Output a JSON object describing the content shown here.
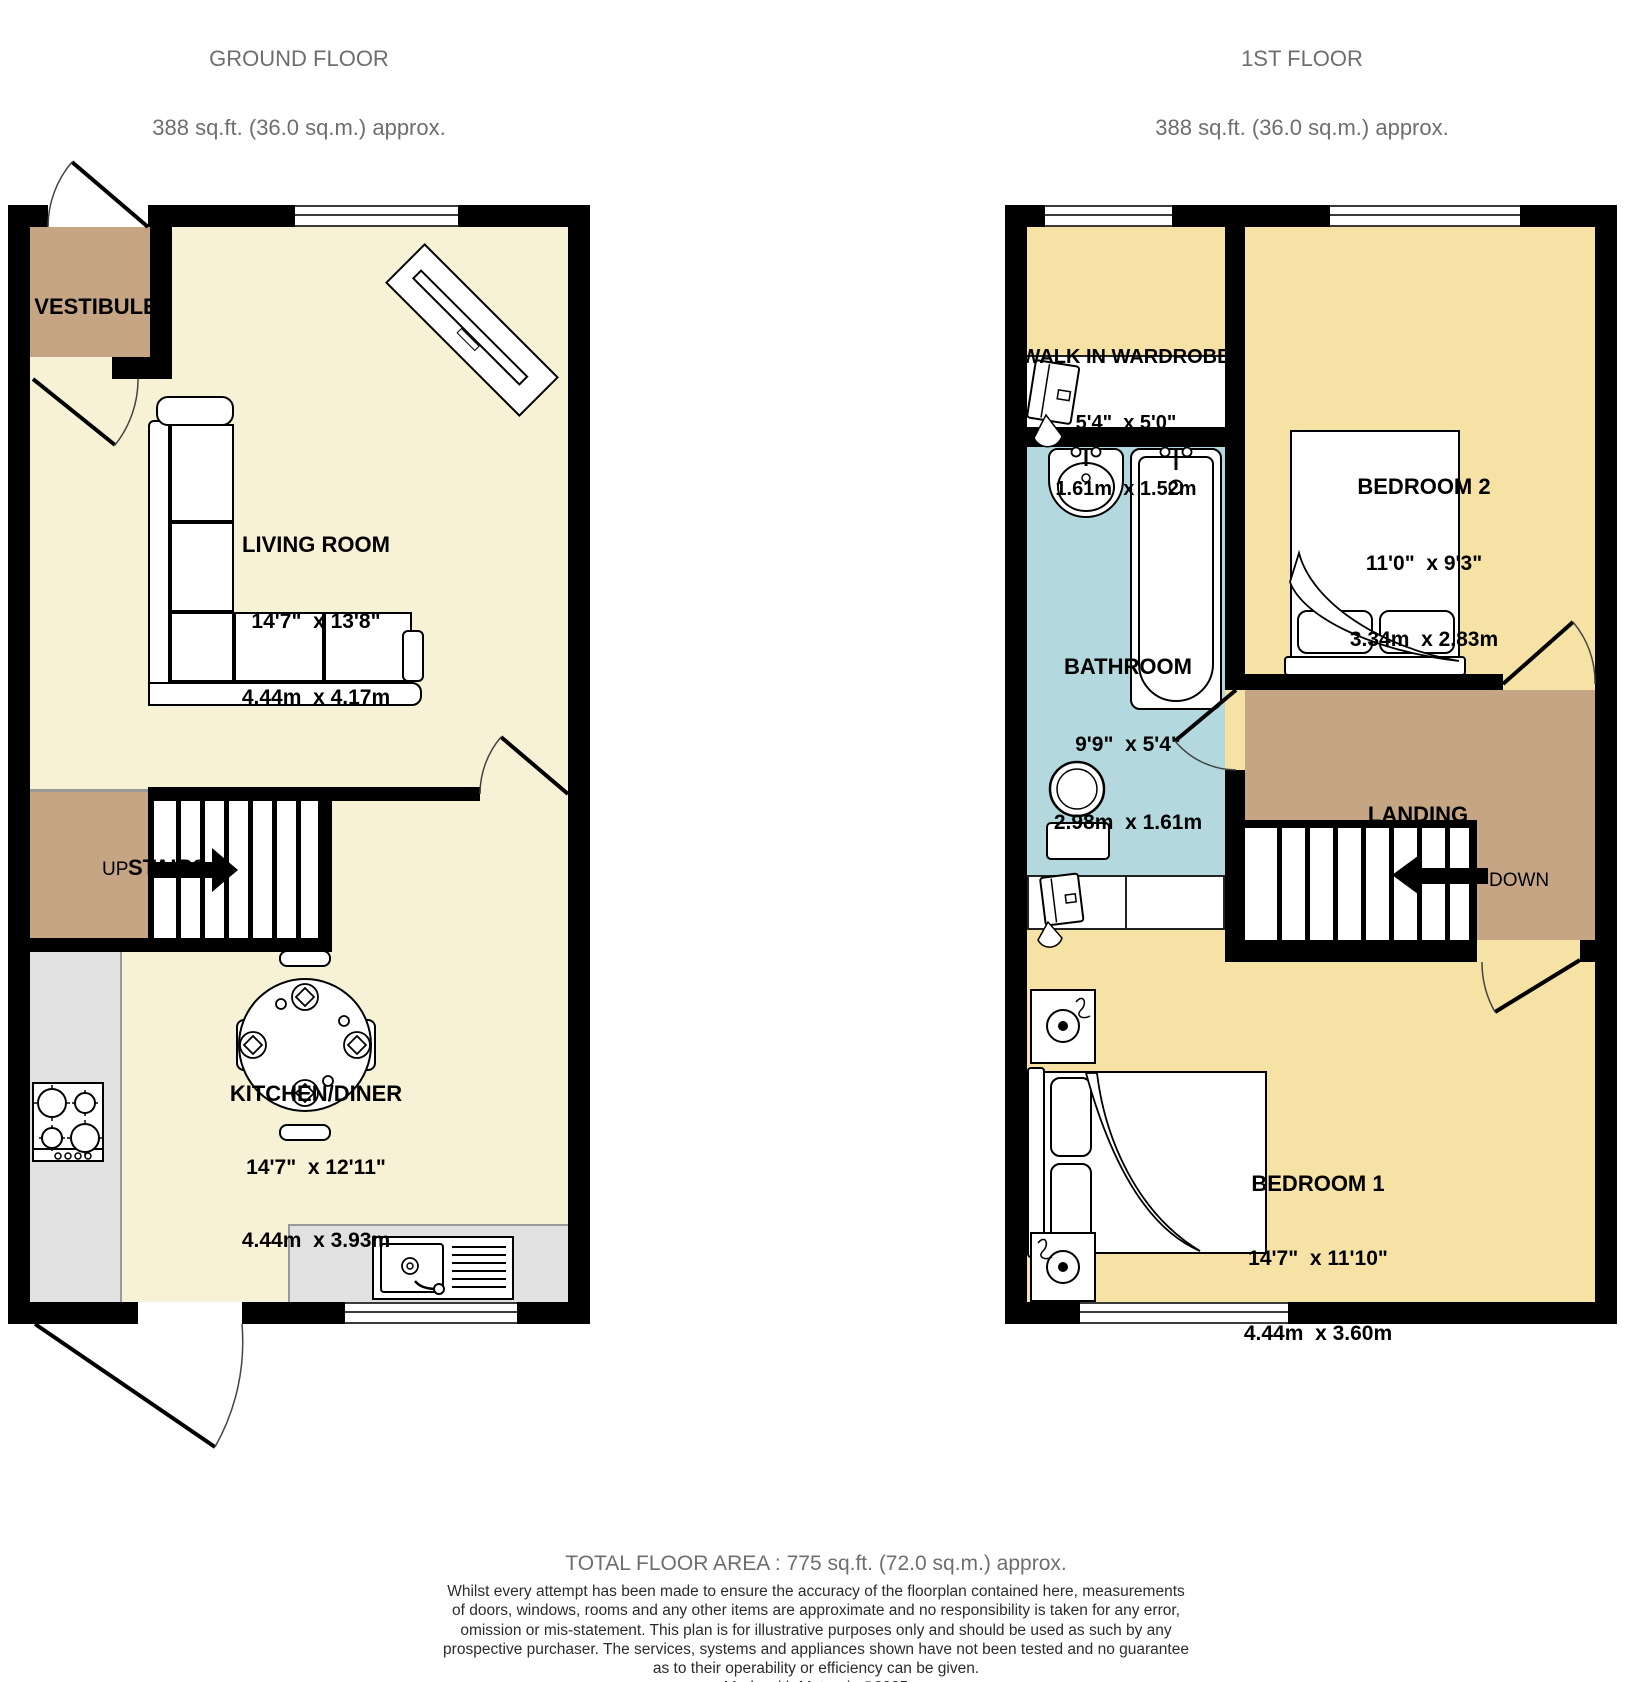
{
  "ground_floor": {
    "title": "GROUND FLOOR",
    "area": "388 sq.ft. (36.0 sq.m.) approx.",
    "rooms": {
      "vestibule": {
        "name": "VESTIBULE"
      },
      "living_room": {
        "name": "LIVING ROOM",
        "imperial": "14'7\"  x 13'8\"",
        "metric": "4.44m  x 4.17m"
      },
      "kitchen_diner": {
        "name": "KITCHEN/DINER",
        "imperial": "14'7\"  x 12'11\"",
        "metric": "4.44m  x 3.93m"
      },
      "stairs": {
        "name": "STAIRS",
        "direction": "UP"
      }
    }
  },
  "first_floor": {
    "title": "1ST FLOOR",
    "area": "388 sq.ft. (36.0 sq.m.) approx.",
    "rooms": {
      "walk_in_wardrobe": {
        "name": "WALK IN WARDROBE",
        "imperial": "5'4\"  x 5'0\"",
        "metric": "1.61m  x 1.52m"
      },
      "bedroom2": {
        "name": "BEDROOM 2",
        "imperial": "11'0\"  x 9'3\"",
        "metric": "3.34m  x 2.83m"
      },
      "bathroom": {
        "name": "BATHROOM",
        "imperial": "9'9\"  x 5'4\"",
        "metric": "2.98m  x 1.61m"
      },
      "landing": {
        "name": "LANDING",
        "direction": "DOWN"
      },
      "bedroom1": {
        "name": "BEDROOM 1",
        "imperial": "14'7\"  x 11'10\"",
        "metric": "4.44m  x 3.60m"
      }
    }
  },
  "footer": {
    "total_area": "TOTAL FLOOR AREA : 775 sq.ft. (72.0 sq.m.) approx.",
    "disclaimer_lines": [
      "Whilst every attempt has been made to ensure the accuracy of the floorplan contained here, measurements",
      "of doors, windows, rooms and any other items are approximate and no responsibility is taken for any error,",
      "omission or mis-statement. This plan is for illustrative purposes only and should be used as such by any",
      "prospective purchaser. The services, systems and appliances shown have not been tested and no guarantee",
      "as to their operability or efficiency can be given."
    ],
    "credit": "Made with Metropix ©2025"
  },
  "colors": {
    "floor_cream": "#f7f2d5",
    "floor_gold": "#f5e2a4",
    "hall_tan": "#c5a584",
    "bathroom_blue": "#b3d9de",
    "counter_grey": "#e1e1e1",
    "wall": "#000000",
    "title_grey": "#6e6e6e"
  }
}
